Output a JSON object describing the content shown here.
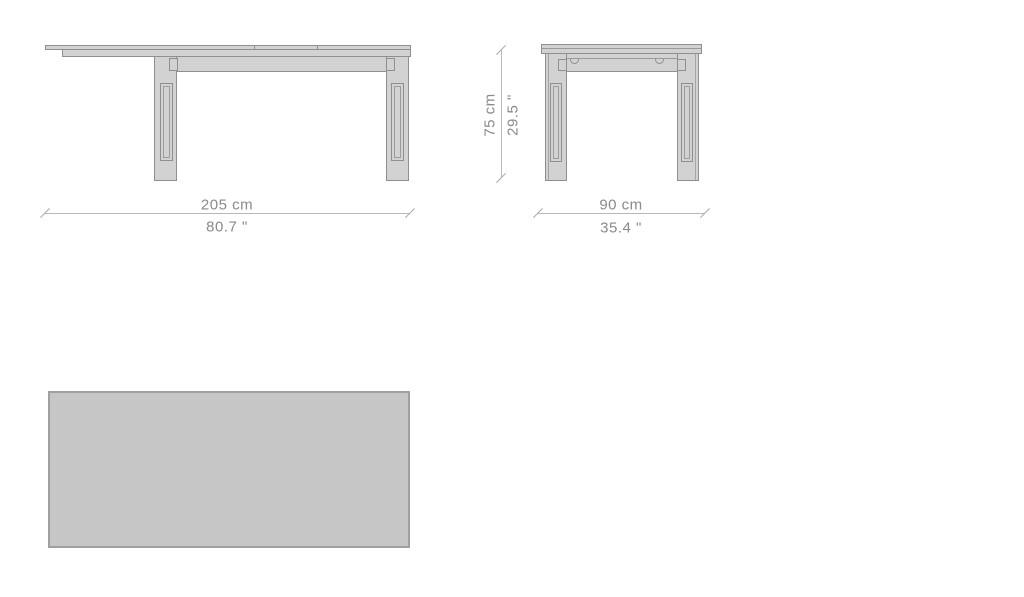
{
  "drawing": {
    "dimensions": {
      "front_width": {
        "cm": "205 cm",
        "inch": "80.7 \""
      },
      "side_depth": {
        "cm": "90 cm",
        "inch": "35.4 \""
      },
      "height": {
        "cm": "75 cm",
        "inch": "29.5 \""
      }
    },
    "colors": {
      "background": "#ffffff",
      "outline": "#8f8f8f",
      "surface_fill": "#d2d2d2",
      "top_view_fill": "#c5c6c5",
      "dimension_line": "#b9b9b9",
      "dimension_text": "#8a8a8a"
    }
  }
}
